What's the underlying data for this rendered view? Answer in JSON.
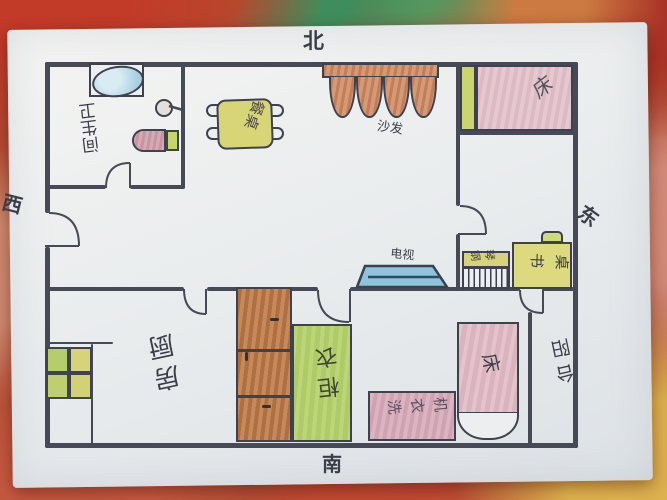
{
  "title": "hand-drawn apartment floor plan (child's drawing)",
  "compass": {
    "north": "北",
    "south": "南",
    "west": "西",
    "east": "东"
  },
  "rooms": {
    "bathroom": {
      "label": "卫生间"
    },
    "kitchen": {
      "label": "厨房"
    },
    "balcony": {
      "label": "阳台"
    }
  },
  "furniture": {
    "bathtub": {
      "label": ""
    },
    "shower": {
      "label": ""
    },
    "toilet": {
      "label": ""
    },
    "dining_table": {
      "label": "餐桌"
    },
    "sofa": {
      "label": "沙发"
    },
    "bed_northeast": {
      "label": "床"
    },
    "piano": {
      "label": "钢琴"
    },
    "desk": {
      "label": "书桌"
    },
    "tv": {
      "label": "电视"
    },
    "stove": {
      "label": ""
    },
    "cabinet": {
      "label": ""
    },
    "wardrobe": {
      "label": "衣柜"
    },
    "washing_machine": {
      "label": "洗衣机"
    },
    "bed_south": {
      "label": "床"
    }
  },
  "colors": {
    "ink": "#454a56",
    "paper": "#eceef0",
    "tub_blue": "#a9d0e2",
    "tv_blue": "#8fc3dc",
    "khaki_table": "#d8d576",
    "pink_bed": "#e6c9d0",
    "pink_washer": "#dcb3c1",
    "green_wardrobe": "#bcd578",
    "wood_brown": "#b5713f",
    "terracotta_sofa": "#c57c58"
  }
}
